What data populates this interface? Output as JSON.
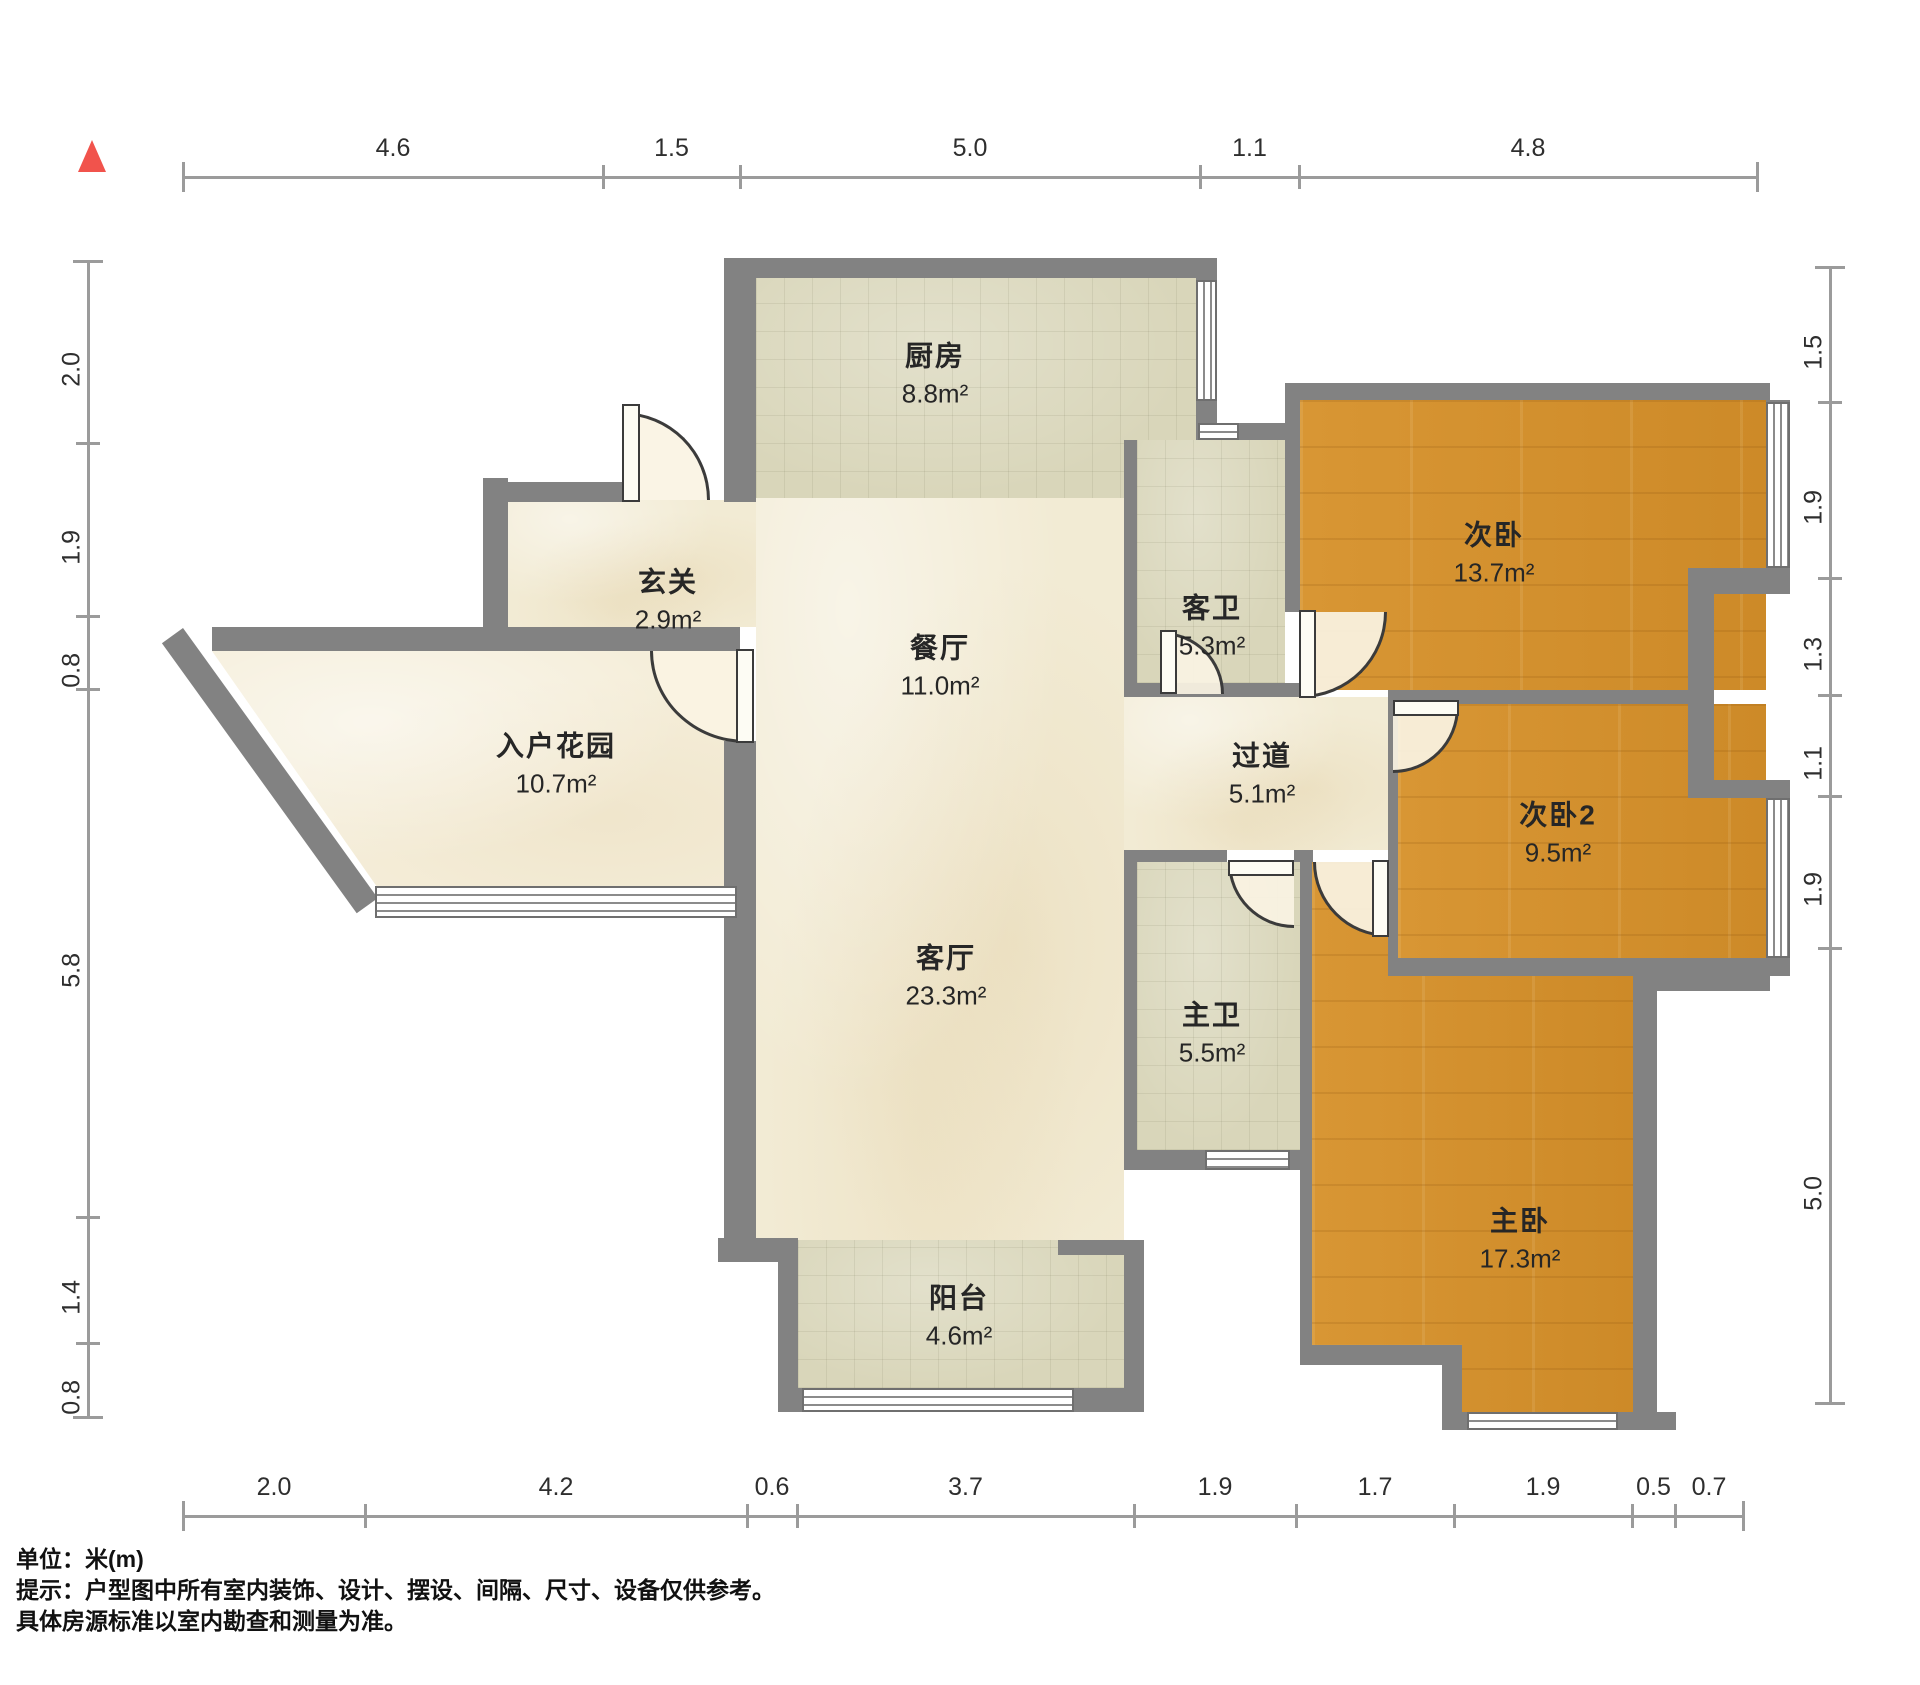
{
  "title": "户型图",
  "unit_note": "米(m)",
  "north_color": "#f1534c",
  "rooms": [
    {
      "id": "kitchen",
      "name": "厨房",
      "area": "8.8m²"
    },
    {
      "id": "entry",
      "name": "玄关",
      "area": "2.9m²"
    },
    {
      "id": "dining",
      "name": "餐厅",
      "area": "11.0m²"
    },
    {
      "id": "guest_bath",
      "name": "客卫",
      "area": "5.3m²"
    },
    {
      "id": "bedroom2",
      "name": "次卧",
      "area": "13.7m²"
    },
    {
      "id": "entry_garden",
      "name": "入户花园",
      "area": "10.7m²"
    },
    {
      "id": "corridor",
      "name": "过道",
      "area": "5.1m²"
    },
    {
      "id": "bedroom3",
      "name": "次卧2",
      "area": "9.5m²"
    },
    {
      "id": "living",
      "name": "客厅",
      "area": "23.3m²"
    },
    {
      "id": "master_bath",
      "name": "主卫",
      "area": "5.5m²"
    },
    {
      "id": "master_bedroom",
      "name": "主卧",
      "area": "17.3m²"
    },
    {
      "id": "balcony",
      "name": "阳台",
      "area": "4.6m²"
    }
  ],
  "dimensions": {
    "top": {
      "labels": [
        "4.6",
        "1.5",
        "5.0",
        "1.1",
        "4.8"
      ]
    },
    "left": {
      "labels": [
        "2.0",
        "1.9",
        "0.8",
        "5.8",
        "1.4",
        "0.8"
      ]
    },
    "right": {
      "labels": [
        "1.5",
        "1.9",
        "1.3",
        "1.1",
        "1.9",
        "5.0"
      ]
    },
    "bottom": {
      "labels": [
        "2.0",
        "4.2",
        "0.6",
        "3.7",
        "1.9",
        "1.7",
        "1.9",
        "0.5",
        "0.7"
      ]
    }
  },
  "footer": {
    "line1": "单位：米(m)",
    "line2": "提示：户型图中所有室内装饰、设计、摆设、间隔、尺寸、设备仅供参考。",
    "line3": "具体房源标准以室内勘查和测量为准。"
  },
  "colors": {
    "wall": "#828282",
    "wood_floor": "#d3922f",
    "tile_floor": "#d9d6ba",
    "marble_floor": "#f2ebd4"
  }
}
